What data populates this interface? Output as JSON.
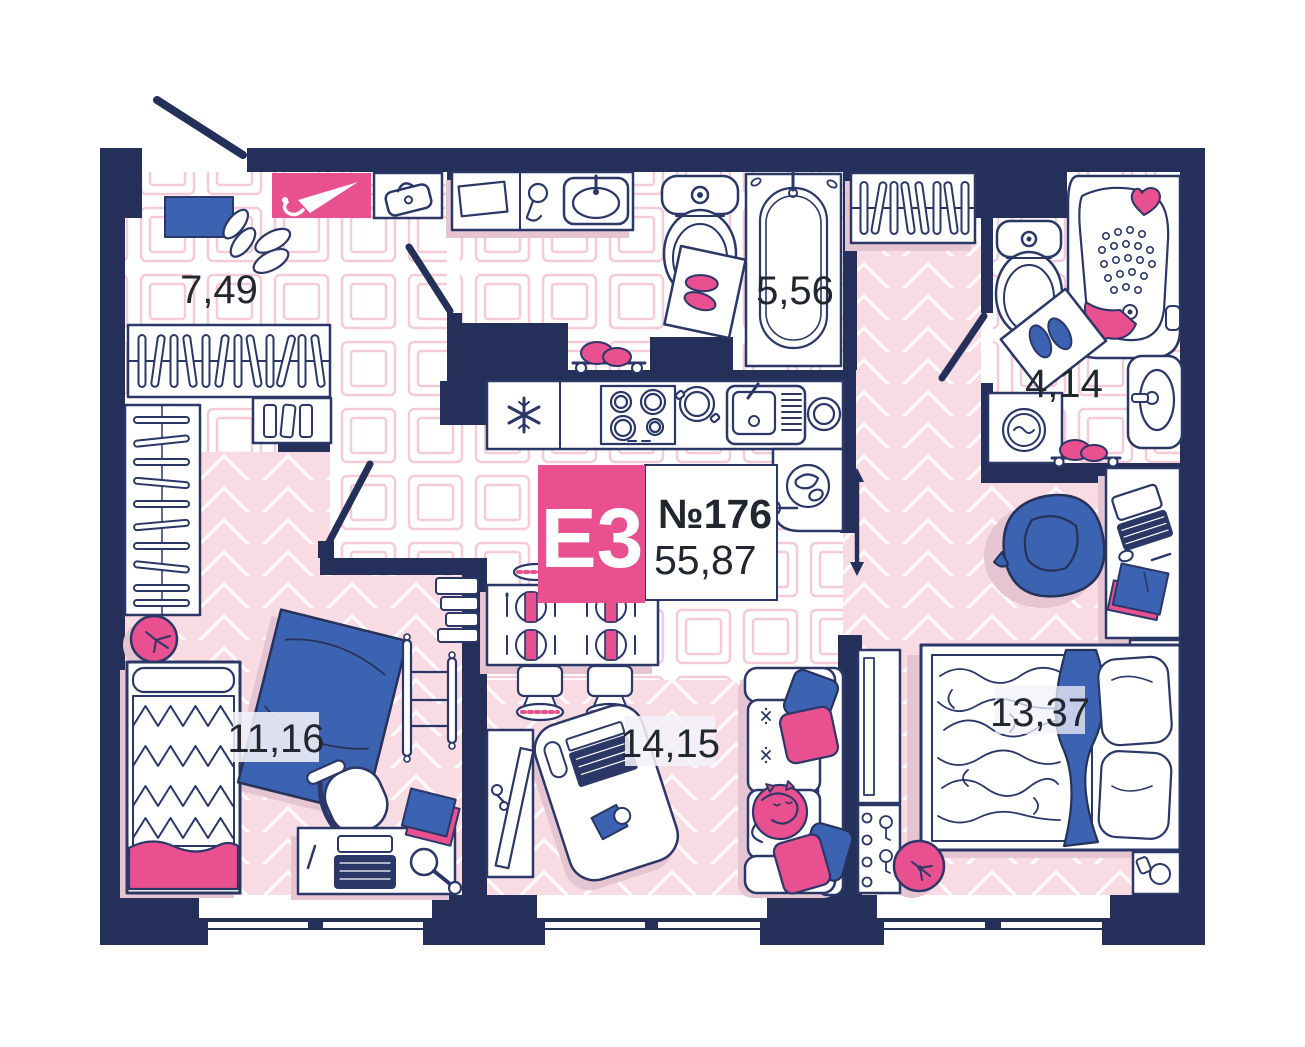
{
  "unit": {
    "layout_code": "E3",
    "number_label": "№176",
    "total_area": "55,87"
  },
  "rooms": [
    {
      "id": "entry-hall",
      "area": "7,49"
    },
    {
      "id": "bathroom",
      "area": "5,56"
    },
    {
      "id": "toilet-laundry",
      "area": "4,14"
    },
    {
      "id": "bedroom-small",
      "area": "11,16"
    },
    {
      "id": "kitchen-living",
      "area": "14,15"
    },
    {
      "id": "bedroom-master",
      "area": "13,37"
    }
  ],
  "colors": {
    "wall_navy": "#25305a",
    "line_navy": "#2b3767",
    "accent_pink": "#e8508f",
    "accent_blue": "#3c63b2",
    "floor_pink": "#f9dbe3",
    "tile_outline": "#f5cbd7",
    "shadow_rose": "#e6c5d2",
    "label_text": "#21262f"
  }
}
